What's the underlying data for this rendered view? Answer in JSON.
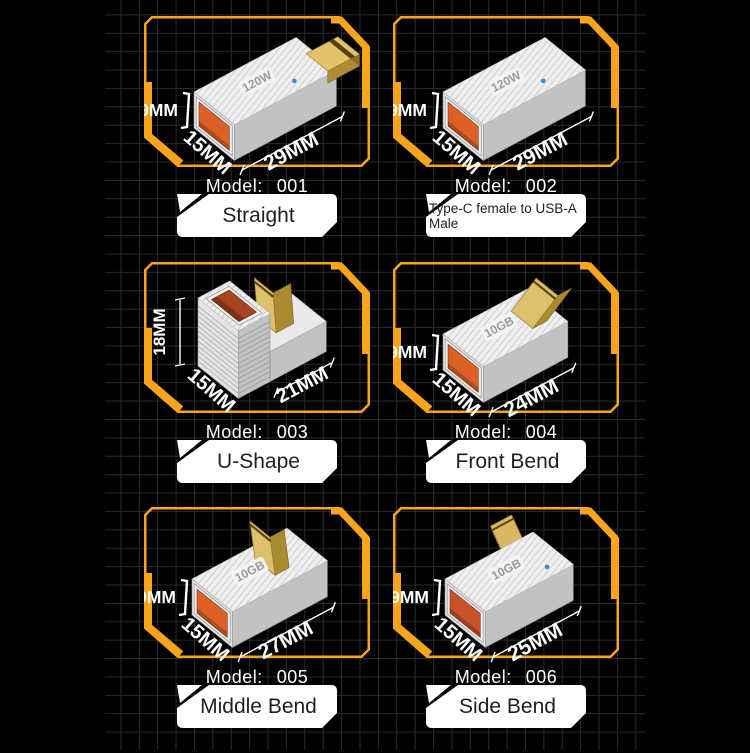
{
  "page": {
    "background": "#000000",
    "grid_line_color": "#2b2b2b",
    "accent_color": "#F9A51B",
    "plate_bg": "#ffffff",
    "plate_text_color": "#1f1f1f",
    "model_label": "Model:",
    "body_color": "#e8e8e8",
    "gold_color": "#DCBE6A",
    "led_color": "#2F8FE8"
  },
  "panels": [
    {
      "model_no": "001",
      "name": "Straight",
      "type": "straight",
      "top_text": "120W",
      "led": true,
      "port_color": "#DD6127",
      "dims": {
        "height": "9MM",
        "width": "15MM",
        "length": "29MM"
      }
    },
    {
      "model_no": "002",
      "name": "Type-C female to USB-A Male",
      "type": "block",
      "top_text": "120W",
      "led": true,
      "port_color": "#DD6127",
      "dims": {
        "height": "9MM",
        "width": "15MM",
        "length": "29MM"
      }
    },
    {
      "model_no": "003",
      "name": "U-Shape",
      "type": "u-shape",
      "top_text": "",
      "led": false,
      "port_color": "#A8431F",
      "dims": {
        "height": "18MM",
        "width": "15MM",
        "length": "21MM"
      }
    },
    {
      "model_no": "004",
      "name": "Front Bend",
      "type": "front-bend",
      "top_text": "10GB",
      "led": false,
      "port_color": "#DD6127",
      "dims": {
        "height": "9MM",
        "width": "15MM",
        "length": "24MM"
      }
    },
    {
      "model_no": "005",
      "name": "Middle Bend",
      "type": "middle-bend",
      "top_text": "10GB",
      "led": false,
      "port_color": "#DD6127",
      "dims": {
        "height": "9MM",
        "width": "15MM",
        "length": "27MM"
      }
    },
    {
      "model_no": "006",
      "name": "Side Bend",
      "type": "side-bend",
      "top_text": "10GB",
      "led": true,
      "port_color": "#C8532A",
      "dims": {
        "height": "9MM",
        "width": "15MM",
        "length": "25MM"
      }
    }
  ]
}
